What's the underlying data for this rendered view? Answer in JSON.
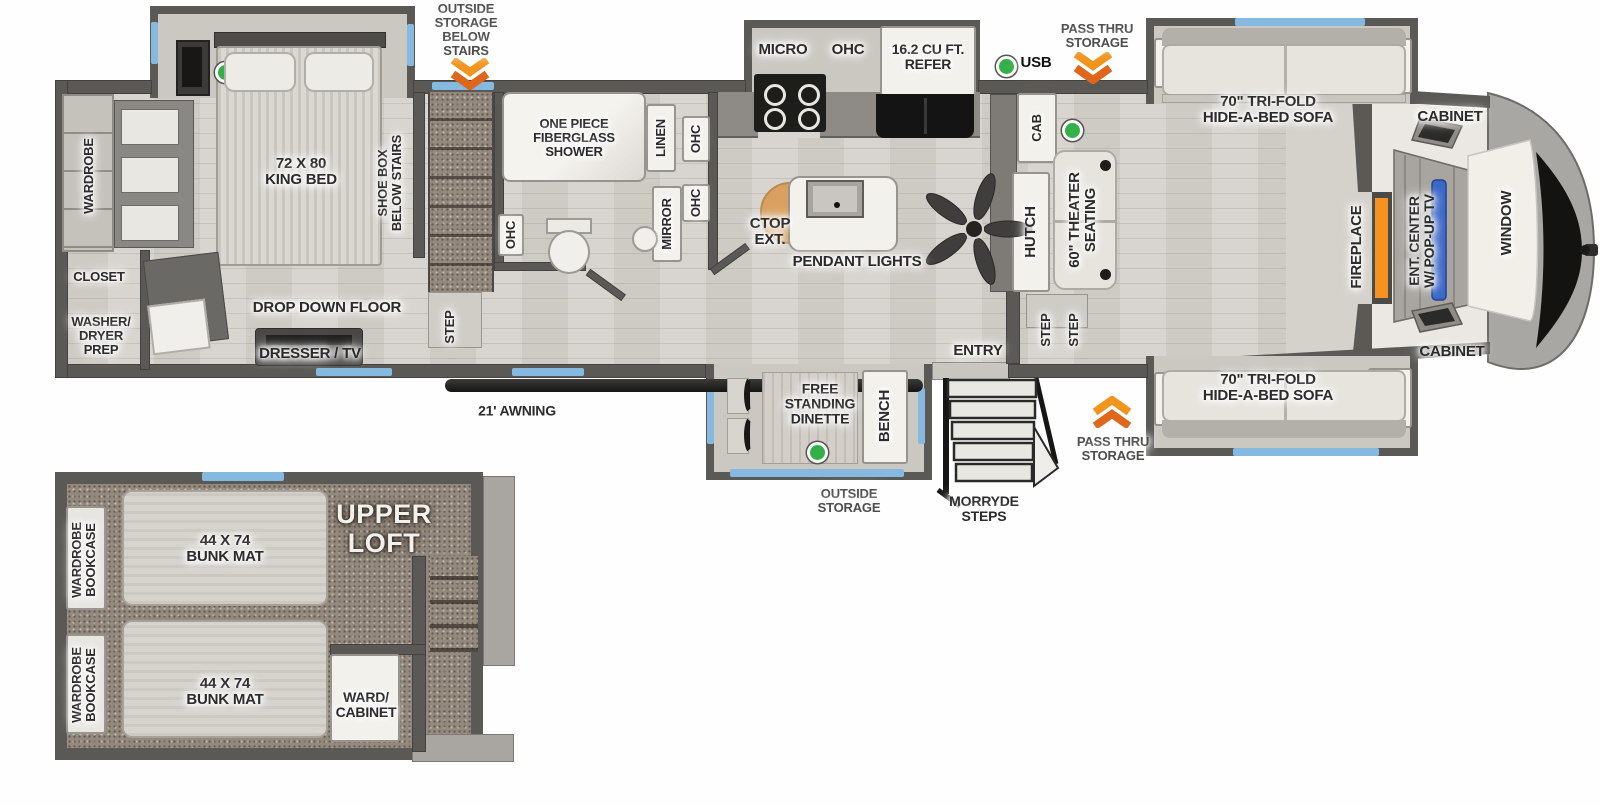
{
  "annotations": {
    "outside_storage_below_stairs": "OUTSIDE\nSTORAGE\nBELOW\nSTAIRS",
    "pass_thru_storage_top": "PASS THRU\nSTORAGE",
    "usb": "USB",
    "awning": "21' AWNING",
    "outside_storage_bottom": "OUTSIDE\nSTORAGE",
    "morryde_steps": "MORRYDE\nSTEPS",
    "pass_thru_storage_bottom": "PASS THRU\nSTORAGE"
  },
  "bedroom": {
    "wardrobe": "WARDROBE",
    "king_bed": "72 X 80\nKING BED",
    "shoe_box": "SHOE BOX\nBELOW STAIRS",
    "closet": "CLOSET",
    "washer_dryer_prep": "WASHER/\nDRYER\nPREP",
    "drop_down_floor": "DROP DOWN FLOOR",
    "dresser_tv": "DRESSER / TV",
    "step": "STEP"
  },
  "bathroom": {
    "shower": "ONE PIECE\nFIBERGLASS\nSHOWER",
    "linen": "LINEN",
    "ohc_left": "OHC",
    "ohc_top": "OHC",
    "ohc_bottom": "OHC",
    "mirror": "MIRROR"
  },
  "kitchen": {
    "micro": "MICRO",
    "ohc": "OHC",
    "refer": "16.2 CU FT.\nREFER",
    "ctop_ext": "CTOP\nEXT.",
    "pendant_lights": "PENDANT LIGHTS",
    "cab": "CAB",
    "hutch": "HUTCH"
  },
  "living": {
    "theater_seating": "60\" THEATER\nSEATING",
    "sofa_top": "70\" TRI-FOLD\nHIDE-A-BED SOFA",
    "sofa_bottom": "70\" TRI-FOLD\nHIDE-A-BED SOFA",
    "cabinet_top": "CABINET",
    "cabinet_bottom": "CABINET",
    "fireplace": "FIREPLACE",
    "ent_center": "ENT. CENTER\nW/ POP-UP TV",
    "window": "WINDOW",
    "entry": "ENTRY",
    "step_1": "STEP",
    "step_2": "STEP"
  },
  "dinette": {
    "free_standing_dinette": "FREE\nSTANDING\nDINETTE",
    "bench": "BENCH"
  },
  "loft": {
    "upper_loft": "UPPER\nLOFT",
    "bunk_mat_1": "44 X 74\nBUNK MAT",
    "bunk_mat_2": "44 X 74\nBUNK MAT",
    "wardrobe_bookcase_1": "WARDROBE\nBOOKCASE",
    "wardrobe_bookcase_2": "WARDROBE\nBOOKCASE",
    "ward_cabinet": "WARD/\nCABINET"
  },
  "colors": {
    "storage_arrow_orange": "#e8791f",
    "usb_dot_green": "#33b148",
    "window_blue": "#85b9e0",
    "tv_blue": "#3a67c9",
    "fireplace_orange": "#f6921e"
  }
}
